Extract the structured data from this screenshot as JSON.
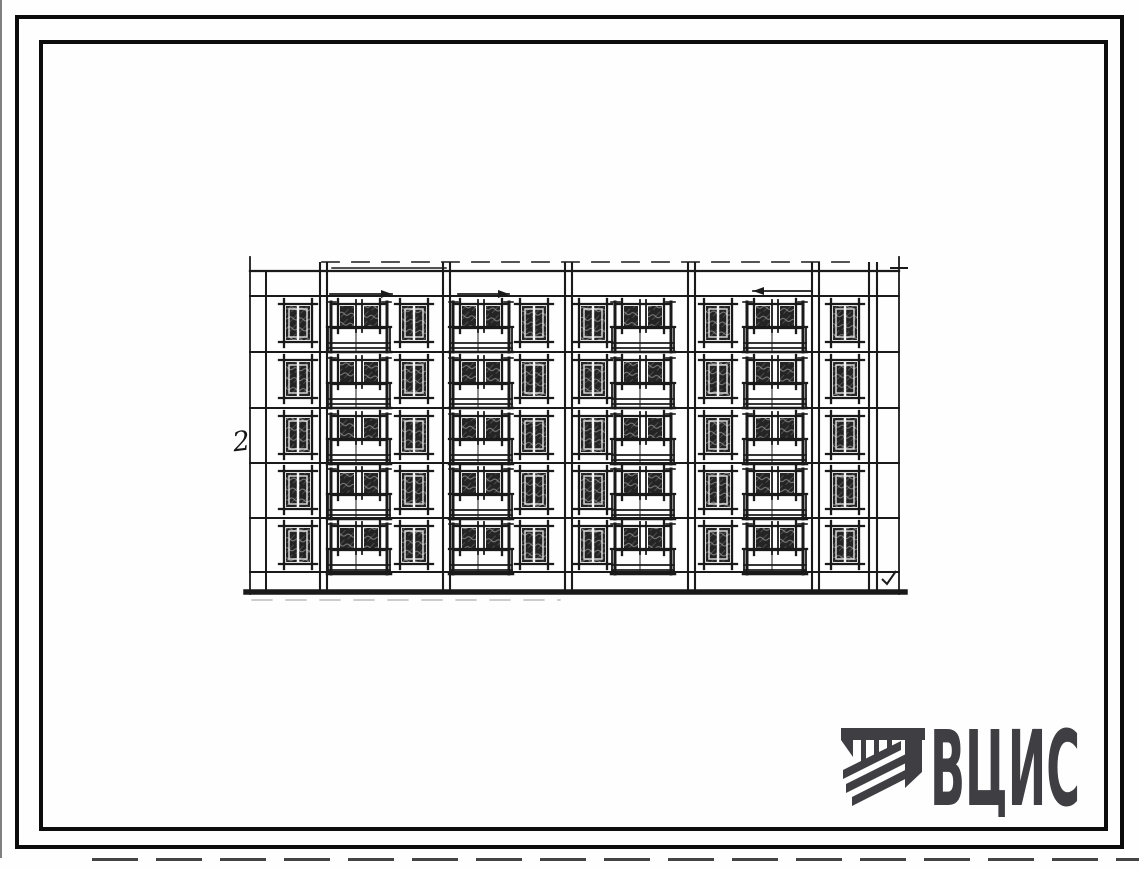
{
  "page": {
    "background": "#fefefe",
    "frame_color": "#0b0b0b",
    "description": "Scanned standard-design sheet: facade elevation sketch of 5-storey large-panel apartment building"
  },
  "drawing": {
    "kind": "hand-sketched building facade elevation, 5 floors",
    "annotation_left": "2",
    "stroke_color": "#1a1a1a",
    "floors_count": 5,
    "single_windows_per_floor": 6,
    "balcony_modules_per_floor": 4,
    "geometry": {
      "top_dash_y": 262,
      "top_line_y": 271,
      "top_double_segment": [
        332,
        446,
        268
      ],
      "floor_top_ys": [
        296,
        352,
        408,
        463,
        518
      ],
      "plinth_line_y": 572,
      "ground_y": 592,
      "left_x": 250,
      "right_x": 899,
      "inner_left_x": 266,
      "divider_xs": [
        320,
        327,
        443,
        450,
        565,
        572,
        688,
        695,
        812,
        819,
        869,
        877
      ],
      "thin_edge_xs": [
        250,
        899
      ],
      "single_window_xs": [
        284,
        400,
        520,
        579,
        704,
        831
      ],
      "single_window_w": 28,
      "single_window_h": 38,
      "balcony_xs": [
        330,
        452,
        614,
        746
      ],
      "balcony_w": 58,
      "arrows": [
        [
          330,
          392,
          294
        ],
        [
          458,
          509,
          294
        ],
        [
          812,
          753,
          291
        ]
      ],
      "top_tick": [
        891,
        907,
        268
      ],
      "check_mark": [
        882,
        579
      ]
    }
  },
  "logo": {
    "text": "ВЦИС",
    "color": "#3e3e43",
    "icon": "striped-column-emblem"
  }
}
